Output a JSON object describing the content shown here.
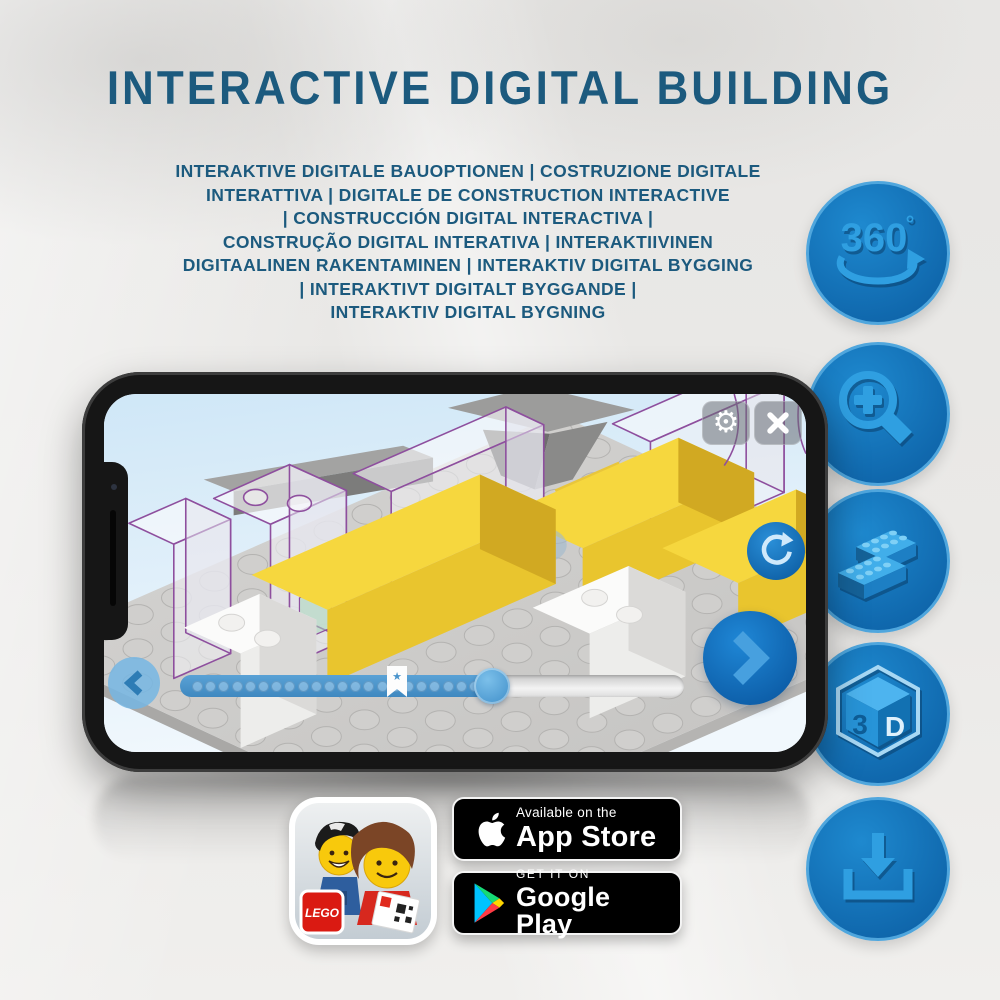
{
  "header": {
    "title": "INTERACTIVE DIGITAL BUILDING"
  },
  "subtitle": {
    "lines": [
      "INTERAKTIVE DIGITALE BAUOPTIONEN | COSTRUZIONE DIGITALE",
      "INTERATTIVA | DIGITALE DE CONSTRUCTION INTERACTIVE",
      "| CONSTRUCCIÓN DIGITAL INTERACTIVA |",
      "CONSTRUÇÃO DIGITAL INTERATIVA | INTERAKTIIVINEN",
      "DIGITAALINEN RAKENTAMINEN | INTERAKTIV DIGITAL BYGGING",
      "| INTERAKTIVT DIGITALT BYGGANDE |",
      "INTERAKTIV DIGITAL BYGNING"
    ]
  },
  "features": [
    {
      "icon": "360-rotation-icon",
      "label": "360",
      "degree": "°"
    },
    {
      "icon": "zoom-in-icon"
    },
    {
      "icon": "brick-stack-icon"
    },
    {
      "icon": "3d-cube-icon",
      "face_left": "3",
      "face_right": "D"
    },
    {
      "icon": "download-icon"
    }
  ],
  "phone": {
    "app": {
      "top_buttons": {
        "gear_glyph": "⚙",
        "close_icon": "x-close-icon"
      },
      "progress": {
        "percent_complete": 62,
        "bookmark_percent": 43,
        "dot_count": 22,
        "bookmark_star_glyph": "★"
      }
    }
  },
  "badges": {
    "lego_app_icon": {
      "logo_text": "LEGO"
    },
    "app_store": {
      "tagline": "Available on the",
      "store_name": "App Store"
    },
    "google_play": {
      "tagline": "GET IT ON",
      "store_name": "Google Play"
    }
  },
  "colors": {
    "title": "#1c5a7e",
    "circle_fill": "#1173b9",
    "circle_ring": "#4fa6dd",
    "glyph_blue": "#2f9fe1",
    "app_blue": "#1778c8",
    "brick_yellow": "#f2cf38",
    "ghost_outline_purple": "#8e4f9e"
  }
}
